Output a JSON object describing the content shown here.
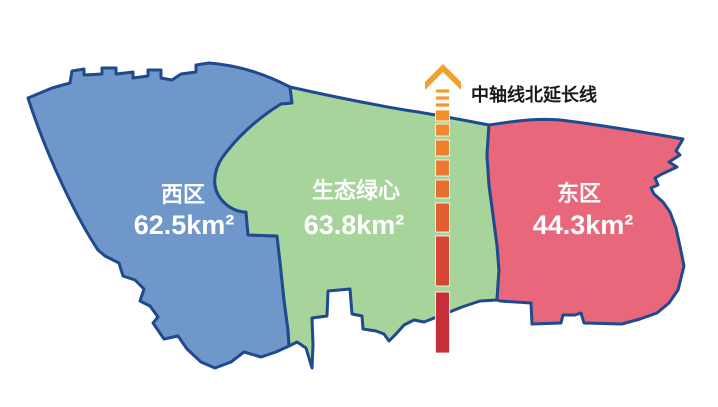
{
  "background": "#FFFFFF",
  "border_color": "#1F4A8F",
  "label_text_color": "#FFFFFF",
  "regions": {
    "west": {
      "name": "西区",
      "area": "62.5km²",
      "fill": "#7097C9"
    },
    "green_heart": {
      "name": "生态绿心",
      "area": "63.8km²",
      "fill": "#A6D49A"
    },
    "east": {
      "name": "东区",
      "area": "44.3km²",
      "fill": "#E8677B"
    }
  },
  "axis": {
    "label": "中轴线北延长线",
    "label_color": "#1A1A1A",
    "arrow_color": "#F2A02C",
    "dash_x": 435.5,
    "dash_width": 14,
    "dashes": [
      {
        "y": 89,
        "h": 4,
        "c": "#F49C2B"
      },
      {
        "y": 96,
        "h": 4,
        "c": "#F3982B"
      },
      {
        "y": 103,
        "h": 4,
        "c": "#F2952C"
      },
      {
        "y": 110,
        "h": 11,
        "c": "#F1902D"
      },
      {
        "y": 124,
        "h": 12,
        "c": "#F0892D"
      },
      {
        "y": 140,
        "h": 16,
        "c": "#EE812E"
      },
      {
        "y": 160,
        "h": 16,
        "c": "#EB792E"
      },
      {
        "y": 180,
        "h": 18,
        "c": "#E86E2F"
      },
      {
        "y": 203,
        "h": 29,
        "c": "#E25E31"
      },
      {
        "y": 236,
        "h": 50,
        "c": "#D74634"
      },
      {
        "y": 292,
        "h": 61,
        "c": "#C42F38"
      }
    ]
  }
}
